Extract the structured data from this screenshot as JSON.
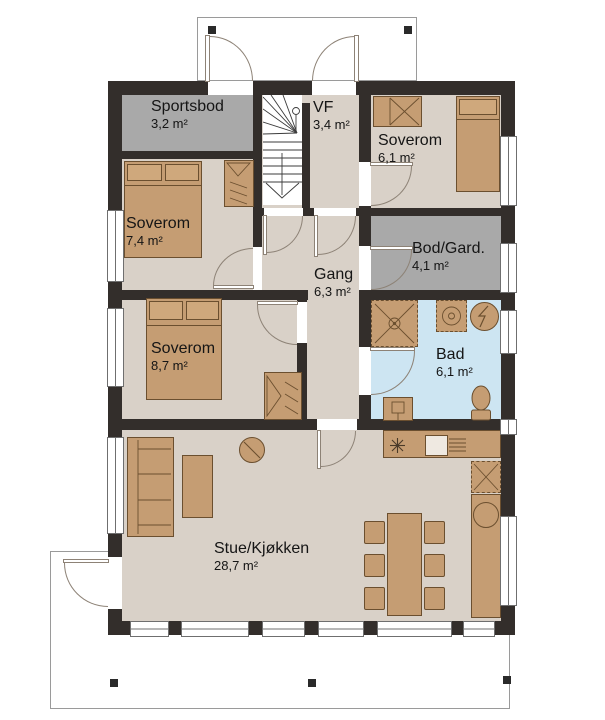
{
  "rooms": [
    {
      "key": "sportsbod",
      "name": "Sportsbod",
      "area": "3,2 m²"
    },
    {
      "key": "vf",
      "name": "VF",
      "area": "3,4 m²"
    },
    {
      "key": "soverom-ne",
      "name": "Soverom",
      "area": "6,1 m²"
    },
    {
      "key": "soverom-w",
      "name": "Soverom",
      "area": "7,4 m²"
    },
    {
      "key": "bod-gard",
      "name": "Bod/Gard.",
      "area": "4,1 m²"
    },
    {
      "key": "gang",
      "name": "Gang",
      "area": "6,3 m²"
    },
    {
      "key": "soverom-sw",
      "name": "Soverom",
      "area": "8,7 m²"
    },
    {
      "key": "bad",
      "name": "Bad",
      "area": "6,1 m²"
    },
    {
      "key": "stue-kjokken",
      "name": "Stue/Kjøkken",
      "area": "28,7 m²"
    }
  ],
  "colors": {
    "wall": "#332e2b",
    "floor": "#d9d1c8",
    "storage": "#a9a9a9",
    "bath": "#cde5f2",
    "furniture": "#c59d73",
    "furniture-border": "#6b4f2f",
    "door-line": "#8d8276",
    "deck-line": "#9a9a9a",
    "window-frame": "#6f6f6f",
    "text": "#151515"
  }
}
